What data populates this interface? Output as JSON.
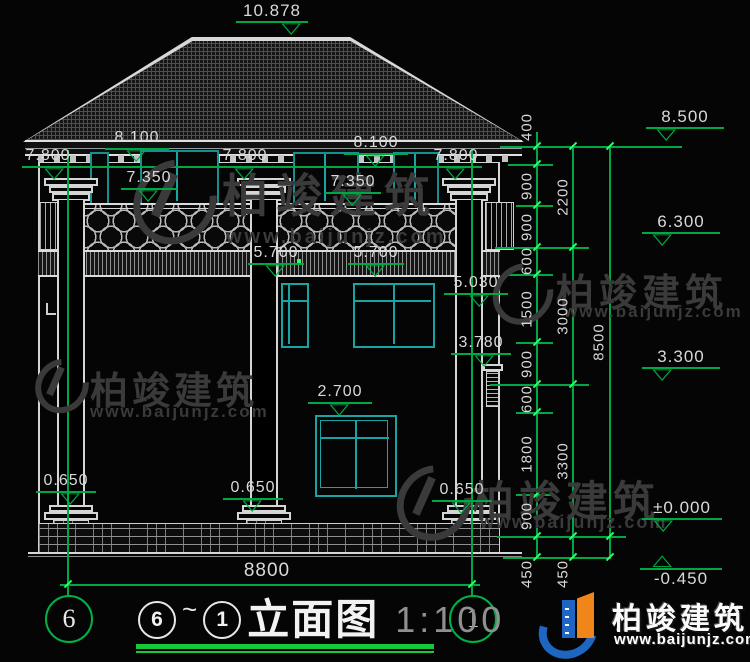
{
  "meta": {
    "drawing_title": "立面图",
    "scale": "1:100",
    "axis_start": "6",
    "axis_end": "1",
    "title_prefix_circles": [
      "6",
      "1"
    ],
    "tilde": "~"
  },
  "dims": {
    "top_ridge": "10.878",
    "inner": [
      "8.100",
      "7.800",
      "7.350",
      "7.800",
      "8.100",
      "7.350",
      "7.800",
      "5.700",
      "5.700",
      "5.030",
      "3.780",
      "2.700",
      "0.650",
      "0.650",
      "0.650"
    ],
    "right_levels": [
      "8.500",
      "6.300",
      "3.300",
      "±0.000",
      "-0.450"
    ],
    "right_col1": [
      "400",
      "900",
      "900",
      "600",
      "1500",
      "900",
      "600",
      "1800",
      "900",
      "450"
    ],
    "right_col2": [
      "2200",
      "3000",
      "3300",
      "450"
    ],
    "right_col3": [
      "8500"
    ],
    "bottom_width": "8800"
  },
  "icons": {
    "level_down": "▽",
    "level_up": "△"
  },
  "watermark": {
    "brand": "柏竣建筑",
    "url": "www.baijunjz.com"
  },
  "brand_footer": {
    "name": "柏竣建筑",
    "url": "www.baijunjz.com"
  },
  "colors": {
    "background": "#050505",
    "drawing_line": "#d5d5d5",
    "dim_green": "#00a843",
    "tick_green": "#2eff62",
    "glass_teal": "#1aa3a3",
    "dim_text": "#d9d9d9",
    "watermark_gray": "#3a3a3a",
    "brand_blue": "#1e66c2",
    "brand_orange": "#f08519"
  }
}
